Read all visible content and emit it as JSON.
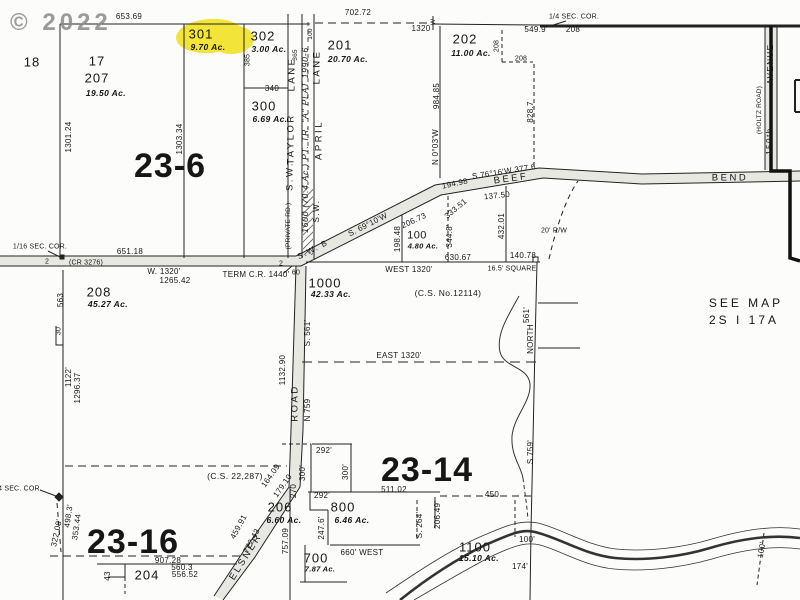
{
  "watermark": "© 2022",
  "highlight_color": "#f2e438",
  "labels": [
    {
      "n": "lot-18",
      "t": "18",
      "x": 32,
      "y": 62,
      "cls": "lot"
    },
    {
      "n": "lot-17",
      "t": "17",
      "x": 97,
      "y": 61,
      "cls": "lot"
    },
    {
      "n": "lot-207",
      "t": "207",
      "x": 97,
      "y": 78,
      "cls": "lot"
    },
    {
      "n": "lot-207-acres",
      "t": "19.50 Ac.",
      "x": 106,
      "y": 93,
      "cls": "acres"
    },
    {
      "n": "lot-301",
      "t": "301",
      "x": 201,
      "y": 34,
      "cls": "lot"
    },
    {
      "n": "lot-301-acres",
      "t": "9.70 Ac.",
      "x": 208,
      "y": 47,
      "cls": "acres"
    },
    {
      "n": "lot-302",
      "t": "302",
      "x": 263,
      "y": 36,
      "cls": "lot"
    },
    {
      "n": "lot-302-acres",
      "t": "3.00 Ac.",
      "x": 269,
      "y": 49,
      "cls": "acres"
    },
    {
      "n": "lot-300",
      "t": "300",
      "x": 264,
      "y": 106,
      "cls": "lot"
    },
    {
      "n": "lot-300-acres",
      "t": "6.69 Ac.",
      "x": 270,
      "y": 119,
      "cls": "acres"
    },
    {
      "n": "lot-201",
      "t": "201",
      "x": 340,
      "y": 45,
      "cls": "lot"
    },
    {
      "n": "lot-201-acres",
      "t": "20.70 Ac.",
      "x": 348,
      "y": 59,
      "cls": "acres"
    },
    {
      "n": "lot-202",
      "t": "202",
      "x": 465,
      "y": 39,
      "cls": "lot"
    },
    {
      "n": "lot-202-acres",
      "t": "11.00 Ac.",
      "x": 471,
      "y": 53,
      "cls": "acres"
    },
    {
      "n": "lot-100",
      "t": "100",
      "x": 417,
      "y": 236,
      "cls": "lot-sm"
    },
    {
      "n": "lot-100-acres",
      "t": "4.80 Ac.",
      "x": 423,
      "y": 246,
      "cls": "acres-sm"
    },
    {
      "n": "lot-1000",
      "t": "1000",
      "x": 325,
      "y": 283,
      "cls": "lot"
    },
    {
      "n": "lot-1000-acres",
      "t": "42.33 Ac.",
      "x": 331,
      "y": 294,
      "cls": "acres"
    },
    {
      "n": "lot-208",
      "t": "208",
      "x": 99,
      "y": 292,
      "cls": "lot"
    },
    {
      "n": "lot-208-acres",
      "t": "45.27 Ac.",
      "x": 108,
      "y": 304,
      "cls": "acres"
    },
    {
      "n": "lot-206",
      "t": "206",
      "x": 280,
      "y": 507,
      "cls": "lot"
    },
    {
      "n": "lot-206-acres",
      "t": "6.60 Ac.",
      "x": 284,
      "y": 520,
      "cls": "acres"
    },
    {
      "n": "lot-204",
      "t": "204",
      "x": 147,
      "y": 575,
      "cls": "lot"
    },
    {
      "n": "lot-700",
      "t": "700",
      "x": 316,
      "y": 558,
      "cls": "lot"
    },
    {
      "n": "lot-700-acres",
      "t": "7.87 Ac.",
      "x": 320,
      "y": 569,
      "cls": "acres-sm"
    },
    {
      "n": "lot-800",
      "t": "800",
      "x": 343,
      "y": 507,
      "cls": "lot"
    },
    {
      "n": "lot-800-acres",
      "t": "6.46 Ac.",
      "x": 352,
      "y": 520,
      "cls": "acres"
    },
    {
      "n": "lot-1100",
      "t": "1100",
      "x": 475,
      "y": 547,
      "cls": "lot"
    },
    {
      "n": "lot-1100-acres",
      "t": "15.10 Ac.",
      "x": 479,
      "y": 558,
      "cls": "acres"
    },
    {
      "n": "section-23-6",
      "t": "23-6",
      "x": 170,
      "y": 166,
      "cls": "section"
    },
    {
      "n": "section-23-14",
      "t": "23-14",
      "x": 427,
      "y": 470,
      "cls": "section"
    },
    {
      "n": "section-23-16",
      "t": "23-16",
      "x": 133,
      "y": 542,
      "cls": "section"
    },
    {
      "n": "dim-653-69",
      "t": "653.69",
      "x": 129,
      "y": 17
    },
    {
      "n": "dim-702-72",
      "t": "702.72",
      "x": 358,
      "y": 13
    },
    {
      "n": "dim-1320-top",
      "t": "1320",
      "x": 421,
      "y": 29
    },
    {
      "n": "cor-w-mark",
      "t": "W",
      "x": 434,
      "y": 22,
      "r": -90,
      "cls": "dim6"
    },
    {
      "n": "dim-549-9",
      "t": "549.9'",
      "x": 536,
      "y": 30
    },
    {
      "n": "dim-208-a",
      "t": "208",
      "x": 573,
      "y": 30
    },
    {
      "n": "dim-208-b",
      "t": "208",
      "x": 497,
      "y": 46,
      "r": -90,
      "cls": "dim7"
    },
    {
      "n": "dim-208-c",
      "t": "208",
      "x": 521,
      "y": 59,
      "cls": "dim7"
    },
    {
      "n": "cor-quarter-top",
      "t": "1/4 SEC. COR.",
      "x": 574,
      "y": 17,
      "cls": "dim7"
    },
    {
      "n": "dim-984-85",
      "t": "984.85",
      "x": 437,
      "y": 96,
      "r": -90
    },
    {
      "n": "brg-n0-03w",
      "t": "N 0°03'W",
      "x": 436,
      "y": 147,
      "r": -90
    },
    {
      "n": "dim-828-7",
      "t": "828.7",
      "x": 531,
      "y": 112,
      "r": -90
    },
    {
      "n": "dim-385",
      "t": "385",
      "x": 248,
      "y": 60,
      "r": -90,
      "cls": "dim7"
    },
    {
      "n": "dim-365",
      "t": "365",
      "x": 296,
      "y": 55,
      "r": -90,
      "cls": "dim6"
    },
    {
      "n": "dim-100-lane",
      "t": "100",
      "x": 311,
      "y": 34,
      "r": -90,
      "cls": "dim6"
    },
    {
      "n": "dim-340",
      "t": "340",
      "x": 272,
      "y": 89
    },
    {
      "n": "dim-1301-24",
      "t": "1301.24",
      "x": 69,
      "y": 137,
      "r": -90
    },
    {
      "n": "dim-1303-34",
      "t": "1303.34",
      "x": 180,
      "y": 139,
      "r": -90
    },
    {
      "n": "cor-sixteenth",
      "t": "1/16 SEC. COR.",
      "x": 40,
      "y": 247,
      "cls": "dim7"
    },
    {
      "n": "dim-651-18",
      "t": "651.18",
      "x": 130,
      "y": 252
    },
    {
      "n": "road-cr-3276",
      "t": "(CR 3276)",
      "x": 86,
      "y": 263,
      "cls": "dim7"
    },
    {
      "n": "mark-2-a",
      "t": "2",
      "x": 47,
      "y": 262,
      "cls": "dim7"
    },
    {
      "n": "mark-2-b",
      "t": "2",
      "x": 281,
      "y": 264,
      "cls": "dim7"
    },
    {
      "n": "dim-w-1320",
      "t": "W. 1320'",
      "x": 164,
      "y": 272
    },
    {
      "n": "dim-1265-42",
      "t": "1265.42",
      "x": 175,
      "y": 281
    },
    {
      "n": "dim-term-cr",
      "t": "TERM C.R. 1440'",
      "x": 256,
      "y": 275
    },
    {
      "n": "dim-60",
      "t": "60",
      "x": 296,
      "y": 273,
      "cls": "dim7"
    },
    {
      "n": "road-sw-b",
      "t": "S.W. B",
      "x": 313,
      "y": 250,
      "r": -27,
      "cls": "road-sm"
    },
    {
      "n": "brg-s69-10w",
      "t": "S. 69°10'W",
      "x": 368,
      "y": 225,
      "r": -27
    },
    {
      "n": "dim-206-73",
      "t": "206.73",
      "x": 414,
      "y": 221,
      "r": -25
    },
    {
      "n": "dim-194-98",
      "t": "194.98",
      "x": 455,
      "y": 184,
      "r": -12
    },
    {
      "n": "brg-s76-16w",
      "t": "S.76°16'W  377.6",
      "x": 504,
      "y": 172,
      "r": -9
    },
    {
      "n": "road-beef",
      "t": "BEEF",
      "x": 511,
      "y": 179,
      "r": -8,
      "cls": "road"
    },
    {
      "n": "road-bend",
      "t": "BEND",
      "x": 730,
      "y": 178,
      "cls": "road"
    },
    {
      "n": "dim-137-50",
      "t": "137.50",
      "x": 497,
      "y": 196,
      "r": -6
    },
    {
      "n": "dim-333-51",
      "t": "333.51",
      "x": 456,
      "y": 209,
      "r": -40
    },
    {
      "n": "dim-344-8",
      "t": "344.8'",
      "x": 450,
      "y": 236,
      "r": -90
    },
    {
      "n": "dim-198-48",
      "t": "198.48",
      "x": 398,
      "y": 239,
      "r": -90
    },
    {
      "n": "dim-432-01",
      "t": "432.01",
      "x": 502,
      "y": 226,
      "r": -90
    },
    {
      "n": "dim-630-67",
      "t": "630.67",
      "x": 458,
      "y": 258
    },
    {
      "n": "dim-west-1320",
      "t": "WEST  1320'",
      "x": 409,
      "y": 270
    },
    {
      "n": "dim-16-5-square",
      "t": "16.5' SQUARE",
      "x": 512,
      "y": 269,
      "cls": "dim7"
    },
    {
      "n": "dim-140-78",
      "t": "140.78",
      "x": 523,
      "y": 256
    },
    {
      "n": "dim-20-rw",
      "t": "20' R/W",
      "x": 554,
      "y": 231,
      "cls": "dim7"
    },
    {
      "n": "note-cs-12114",
      "t": "(C.S. No.12114)",
      "x": 448,
      "y": 293,
      "cls": "note-sm"
    },
    {
      "n": "dim-east-1320",
      "t": "EAST  1320'",
      "x": 399,
      "y": 356
    },
    {
      "n": "dim-s-561",
      "t": "S. 561'",
      "x": 308,
      "y": 333,
      "r": -90
    },
    {
      "n": "dim-n-759",
      "t": "N 759",
      "x": 308,
      "y": 410,
      "r": -90
    },
    {
      "n": "road-road",
      "t": "ROAD",
      "x": 295,
      "y": 403,
      "r": -90,
      "cls": "road"
    },
    {
      "n": "dim-1132-90",
      "t": "1132.90",
      "x": 283,
      "y": 370,
      "r": -90
    },
    {
      "n": "dim-561",
      "t": "561'",
      "x": 527,
      "y": 315,
      "r": -90
    },
    {
      "n": "dim-north",
      "t": "NORTH",
      "x": 531,
      "y": 339,
      "r": -90
    },
    {
      "n": "dim-563",
      "t": "563",
      "x": 61,
      "y": 300,
      "r": -90
    },
    {
      "n": "dim-30",
      "t": "30",
      "x": 59,
      "y": 331,
      "r": -90,
      "cls": "dim7"
    },
    {
      "n": "dim-1122",
      "t": "1122'",
      "x": 69,
      "y": 377,
      "r": -90
    },
    {
      "n": "dim-1296-37",
      "t": "1296.37",
      "x": 78,
      "y": 388,
      "r": -90
    },
    {
      "n": "note-cs-22287",
      "t": "(C.S. 22,287)",
      "x": 235,
      "y": 476,
      "cls": "note-sm"
    },
    {
      "n": "dim-164-09",
      "t": "164.09",
      "x": 271,
      "y": 476,
      "r": -55
    },
    {
      "n": "dim-179-10",
      "t": "179.10",
      "x": 283,
      "y": 486,
      "r": -55
    },
    {
      "n": "dim-270",
      "t": "270",
      "x": 294,
      "y": 491,
      "r": -90
    },
    {
      "n": "dim-459-91",
      "t": "459.91",
      "x": 239,
      "y": 527,
      "r": -62
    },
    {
      "n": "dim-772-43",
      "t": "772.43",
      "x": 252,
      "y": 541,
      "r": -62
    },
    {
      "n": "road-elsner",
      "t": "ELSNER",
      "x": 246,
      "y": 557,
      "r": -58,
      "cls": "road"
    },
    {
      "n": "dim-757-09",
      "t": "757.09",
      "x": 286,
      "y": 541,
      "r": -90
    },
    {
      "n": "dim-907-28",
      "t": "907.28",
      "x": 168,
      "y": 561
    },
    {
      "n": "dim-560-3",
      "t": "560.3",
      "x": 182,
      "y": 568
    },
    {
      "n": "dim-556-52",
      "t": "556.52",
      "x": 185,
      "y": 575
    },
    {
      "n": "dim-43",
      "t": "43",
      "x": 108,
      "y": 576,
      "r": -90
    },
    {
      "n": "dim-322-08",
      "t": "322.08'",
      "x": 57,
      "y": 533,
      "r": -78
    },
    {
      "n": "dim-498-3",
      "t": "498.3'",
      "x": 69,
      "y": 516,
      "r": -82
    },
    {
      "n": "dim-353-44",
      "t": "353.44",
      "x": 77,
      "y": 527,
      "r": -82
    },
    {
      "n": "cor-quarter-left",
      "t": "4 SEC. COR.",
      "x": 20,
      "y": 489,
      "cls": "dim7"
    },
    {
      "n": "dim-292-a",
      "t": "292'",
      "x": 324,
      "y": 451
    },
    {
      "n": "dim-300-a",
      "t": "300'",
      "x": 303,
      "y": 473,
      "r": -90
    },
    {
      "n": "dim-300-b",
      "t": "300'",
      "x": 346,
      "y": 472,
      "r": -90
    },
    {
      "n": "dim-292-b",
      "t": "292'",
      "x": 322,
      "y": 496
    },
    {
      "n": "dim-511-02",
      "t": "511.02",
      "x": 394,
      "y": 490
    },
    {
      "n": "dim-247-6",
      "t": "247.6'",
      "x": 322,
      "y": 528,
      "r": -90
    },
    {
      "n": "dim-660-west",
      "t": "660' WEST",
      "x": 362,
      "y": 553
    },
    {
      "n": "dim-s-264",
      "t": "S. 264'",
      "x": 420,
      "y": 525,
      "r": -90
    },
    {
      "n": "dim-206-49",
      "t": "206.49'",
      "x": 438,
      "y": 515,
      "r": -90
    },
    {
      "n": "dim-450",
      "t": "450",
      "x": 492,
      "y": 495
    },
    {
      "n": "dim-100-a",
      "t": "100'",
      "x": 527,
      "y": 540
    },
    {
      "n": "dim-100-b",
      "t": "100'",
      "x": 762,
      "y": 550,
      "r": -80
    },
    {
      "n": "dim-174",
      "t": "174'",
      "x": 520,
      "y": 567
    },
    {
      "n": "dim-s-759",
      "t": "S 759'",
      "x": 531,
      "y": 452,
      "r": -90
    },
    {
      "n": "note-see-map",
      "t": "SEE MAP",
      "x": 746,
      "y": 303,
      "cls": "note"
    },
    {
      "n": "note-see-map-ref",
      "t": "2S  I  17A",
      "x": 744,
      "y": 320,
      "cls": "note"
    },
    {
      "n": "road-150th",
      "t": "150th",
      "x": 770,
      "y": 141,
      "r": -90,
      "cls": "road-sm"
    },
    {
      "n": "road-avenue",
      "t": "AVENUE",
      "x": 771,
      "y": 64,
      "r": -90,
      "cls": "road-sm"
    },
    {
      "n": "road-holtz",
      "t": "(HOLTZ ROAD)",
      "x": 760,
      "y": 110,
      "r": -90,
      "cls": "dim6"
    },
    {
      "n": "plat-1600",
      "t": "1600 (70.4 Ac.) PT. TR. \"A\" PLAT 1990-6",
      "x": 305,
      "y": 140,
      "r": -90,
      "cls": "plat"
    },
    {
      "n": "road-lane-taylor",
      "t": "LANE",
      "x": 292,
      "y": 74,
      "r": -90,
      "cls": "road"
    },
    {
      "n": "road-taylor",
      "t": "TAYLOR",
      "x": 291,
      "y": 139,
      "r": -90,
      "cls": "road"
    },
    {
      "n": "road-sw-taylor",
      "t": "S.W.",
      "x": 290,
      "y": 176,
      "r": -90,
      "cls": "road"
    },
    {
      "n": "road-private",
      "t": "(PRIVATE RD.)",
      "x": 289,
      "y": 226,
      "r": -90,
      "cls": "dim6"
    },
    {
      "n": "road-lane-april",
      "t": "LANE",
      "x": 317,
      "y": 67,
      "r": -90,
      "cls": "road"
    },
    {
      "n": "road-april",
      "t": "APRIL",
      "x": 319,
      "y": 140,
      "r": -90,
      "cls": "road"
    },
    {
      "n": "road-sw-april",
      "t": "S.W.",
      "x": 317,
      "y": 211,
      "r": -90,
      "cls": "road-sm"
    }
  ]
}
